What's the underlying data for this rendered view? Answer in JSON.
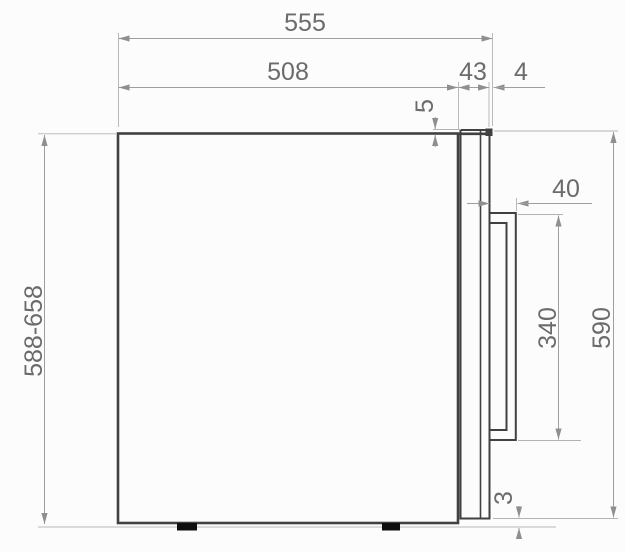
{
  "drawing": {
    "type": "appliance-side-view-dimension-drawing",
    "dimensions": {
      "overall_depth": "555",
      "body_depth": "508",
      "door_thickness": "43",
      "front_trim_gap": "4",
      "door_top_offset": "5",
      "handle_depth": "40",
      "handle_length": "340",
      "door_height": "590",
      "overall_height_range": "588-658",
      "door_bottom_gap": "3"
    },
    "colors": {
      "object_line": "#414141",
      "dimension_line": "#9e9e9e",
      "text": "#6b6b6b",
      "feet": "#0e0e0e",
      "background": "#fcfcfc"
    }
  }
}
